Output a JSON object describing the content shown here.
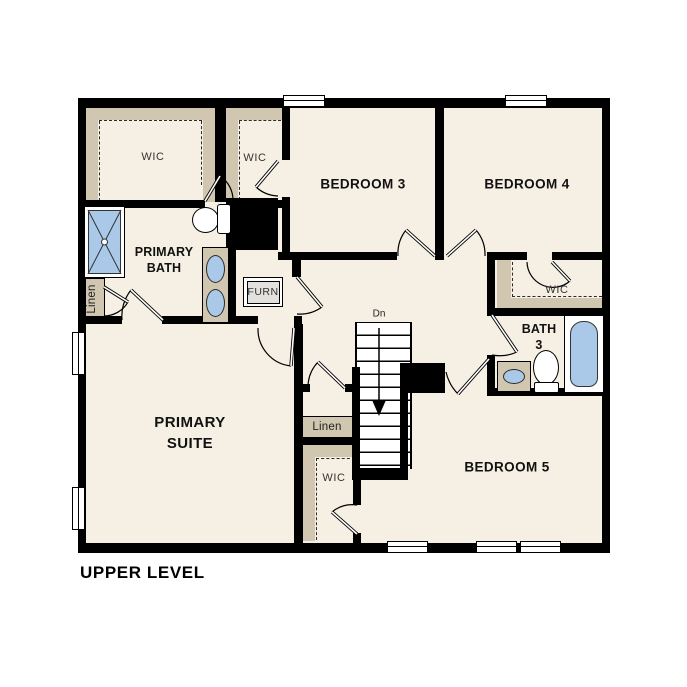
{
  "title": "UPPER LEVEL",
  "colors": {
    "floor": "#f6efe3",
    "casework_tan": "#d1c6af",
    "wall": "#000000",
    "fixture_blue": "#aac9e8",
    "appliance_gray": "#e2e1de"
  },
  "rooms": {
    "primary_suite": {
      "line1": "PRIMARY",
      "line2": "SUITE"
    },
    "primary_bath": {
      "line1": "PRIMARY",
      "line2": "BATH"
    },
    "bedroom3": {
      "label": "BEDROOM 3"
    },
    "bedroom4": {
      "label": "BEDROOM 4"
    },
    "bedroom5": {
      "label": "BEDROOM 5"
    },
    "bath3": {
      "line1": "BATH",
      "line2": "3"
    }
  },
  "closets": {
    "primary_wic": {
      "label": "WIC"
    },
    "bedroom3_wic": {
      "label": "WIC"
    },
    "bedroom4_wic": {
      "label": "WIC"
    },
    "bedroom5_wic": {
      "label": "WIC"
    },
    "bath_linen": {
      "label": "Linen"
    },
    "hall_linen": {
      "label": "Linen"
    }
  },
  "utility": {
    "furnace": {
      "label": "FURN"
    }
  },
  "stairs": {
    "label": "Dn",
    "direction": "down"
  },
  "windows": {
    "top": 2,
    "bottom": 3,
    "left": 2
  },
  "fixtures": [
    "shower",
    "toilet",
    "double-vanity",
    "bathtub",
    "vanity-sink"
  ]
}
